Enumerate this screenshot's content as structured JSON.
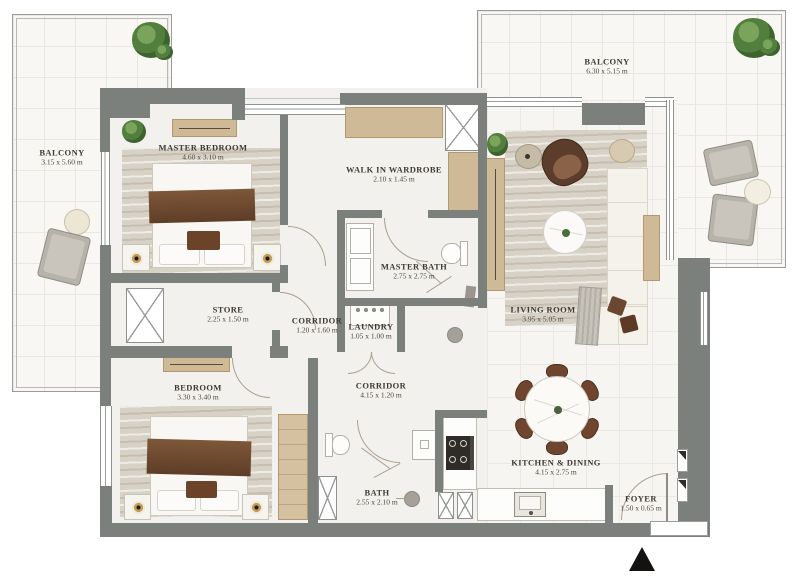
{
  "plan_type": "apartment-floor-plan",
  "rooms": [
    {
      "id": "balcony-left",
      "name": "BALCONY",
      "dims": "3.15 x 5.60 m"
    },
    {
      "id": "balcony-right",
      "name": "BALCONY",
      "dims": "6.30  x  5.15 m"
    },
    {
      "id": "master-bedroom",
      "name": "MASTER BEDROOM",
      "dims": "4.60 x 3.10 m"
    },
    {
      "id": "walk-in-wardrobe",
      "name": "WALK IN WARDROBE",
      "dims": "2.10 x 1.45 m"
    },
    {
      "id": "master-bath",
      "name": "MASTER BATH",
      "dims": "2.75 x 2.75 m"
    },
    {
      "id": "living-room",
      "name": "LIVING ROOM",
      "dims": "3.95 x 5.05 m"
    },
    {
      "id": "store",
      "name": "STORE",
      "dims": "2.25 x 1.50 m"
    },
    {
      "id": "corridor-1",
      "name": "CORRIDOR",
      "dims": "1.20 x 1.60 m"
    },
    {
      "id": "laundry",
      "name": "LAUNDRY",
      "dims": "1.05 x 1.00 m"
    },
    {
      "id": "bedroom",
      "name": "BEDROOM",
      "dims": "3.30 x 3.40 m"
    },
    {
      "id": "corridor-2",
      "name": "CORRIDOR",
      "dims": "4.15 x 1.20 m"
    },
    {
      "id": "bath",
      "name": "BATH",
      "dims": "2.55 x 2.10 m"
    },
    {
      "id": "kitchen-dining",
      "name": "KITCHEN & DINING",
      "dims": "4.15 x 2.75 m"
    },
    {
      "id": "foyer",
      "name": "FOYER",
      "dims": "1.50 x 0.65 m"
    }
  ],
  "icons": {
    "entrance_marker": "north-arrow-triangle"
  },
  "colors": {
    "wall": "#7c807c",
    "floor": "#f3f1ed",
    "balcony_floor": "#f8f7f3",
    "wood": "#cfba98",
    "accent_brown": "#6d4a31",
    "marker_black": "#141210"
  }
}
